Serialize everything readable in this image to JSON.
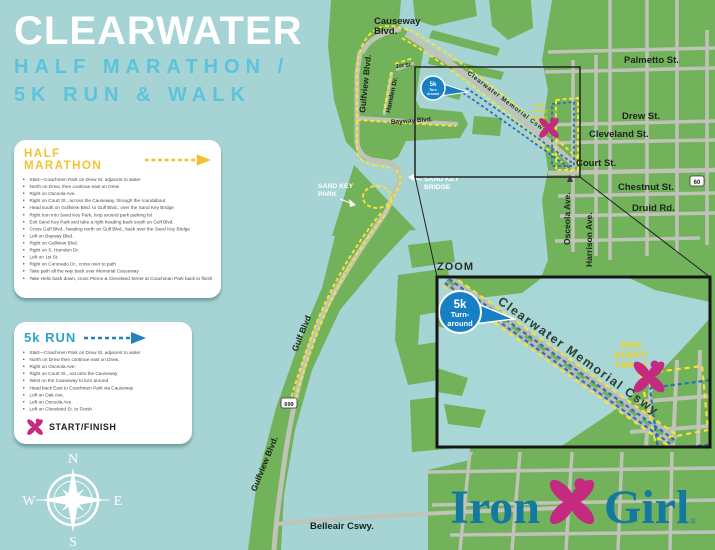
{
  "poster": {
    "title": "CLEARWATER",
    "subtitle_line1": "HALF MARATHON /",
    "subtitle_line2": "5K RUN & WALK"
  },
  "half_marathon": {
    "heading": "HALF MARATHON",
    "steps": [
      "Start—Coachmen Park on Drew St. adjacent to water",
      "North on Drew, then continue east on Drew",
      "Right on Osceola Ave.",
      "Right on Court St., across the Causeway, through the roundabout",
      "Head south on Gulfview Blvd. to Gulf Blvd., over the Sand Key Bridge",
      "Right turn into Sand Key Park, loop around park parking lot",
      "Exit Sand Key Park and take a right heading back south on Gulf Blvd.",
      "Cross Gulf Blvd., heading north on Gulf Blvd., back over the Sand Key Bridge",
      "Left on Bayway Blvd.",
      "Right on Gulfview Blvd.",
      "Right on S. Hamden Dr.",
      "Left on 1st St.",
      "Right on Coronado Dr., cross over to path",
      "Take path all the way back over Memorial Causeway",
      "Take Helix back down, cross Pierce & Cleveland Street at Coachman Park back to finish"
    ]
  },
  "five_k": {
    "heading": "5k RUN",
    "steps": [
      "Start—Coachmen Park on Drew St. adjacent to water",
      "North on Drew then continue east on Drew,",
      "Right on Osceola Ave.",
      "Right on Court St., out onto the Causeway",
      "West on the Causeway to turn around",
      "Head back East to Coachmen Park via Causeway",
      "Left on Oak Ave.",
      "Left on Osceola Ave.",
      "Left on Cleveland St. to Finish"
    ],
    "legend": "START/FINISH"
  },
  "compass": {
    "north": "N",
    "south": "S",
    "east": "E",
    "west": "W"
  },
  "map": {
    "streets": {
      "causeway_blvd_line1": "Causeway",
      "causeway_blvd_line2": "Blvd.",
      "gulfview_blvd_island": "Gulfview Blvd.",
      "first_st": "1st St.",
      "hamden_dr": "Hamden Dr.",
      "bayway_blvd": "Bayway Blvd.",
      "memorial_cswy": "Clearwater Memorial Cswy.",
      "palmetto_st": "Palmetto St.",
      "drew_st": "Drew St.",
      "cleveland_st": "Cleveland St.",
      "court_st": "Court St.",
      "chestnut_st": "Chestnut St.",
      "druid_rd": "Druid Rd.",
      "osceola_ave": "Osceola Ave.",
      "harrison_ave": "Harrison Ave.",
      "gulf_blvd": "Gulf Blvd",
      "gulfview_blvd_south": "Gulfview Blvd.",
      "belleair_cswy": "Belleair Cswy."
    },
    "shields": {
      "route_60": "60",
      "route_699": "699"
    },
    "sand_key_park_line1": "SAND KEY",
    "sand_key_park_line2": "PARK",
    "sand_key_bridge_line1": "SAND KEY",
    "sand_key_bridge_line2": "BRIDGE",
    "run_start_finish_line1": "RUN",
    "run_start_finish_line2": "START/",
    "run_start_finish_line3": "FINISH",
    "callout_5k_line1": "5k",
    "callout_5k_line2": "Turn",
    "callout_5k_line3": "Around",
    "zoom_label": "ZOOM",
    "inset": {
      "memorial_cswy": "Clearwater Memorial Cswy",
      "callout_line1": "5k",
      "callout_line2": "Turn-",
      "callout_line3": "around",
      "run_start_finish_line1": "RUN",
      "run_start_finish_line2": "START/",
      "run_start_finish_line3": "FINISH"
    }
  },
  "logo": {
    "word1": "Iron",
    "word2": "Girl",
    "registered": "®"
  },
  "colors": {
    "water": "#a6d3d4",
    "land": "#72b25a",
    "road": "#bfc3b8",
    "half_marathon_route": "#f6e339",
    "five_k_route": "#2e6fbc",
    "accent_pink": "#c42a80",
    "logo_teal": "#14799e",
    "title_blue": "#5cc3dd",
    "callout_blue": "#1780c4",
    "start_finish_yellow": "#f3d01e"
  }
}
